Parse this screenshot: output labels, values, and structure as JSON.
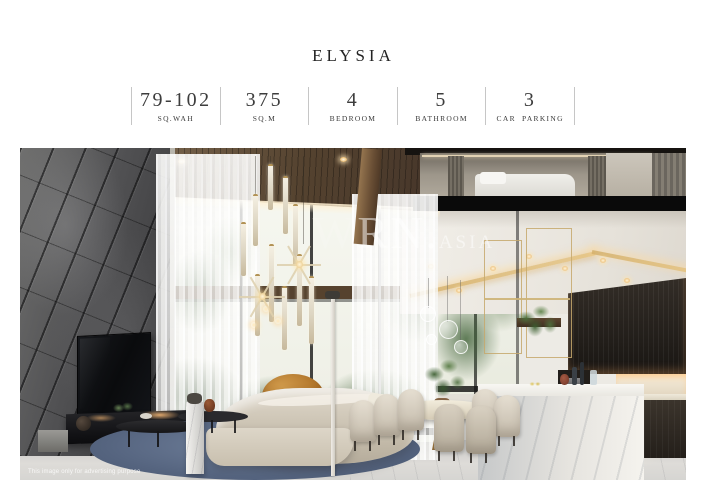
{
  "header": {
    "title": "ELYSIA"
  },
  "specs": [
    {
      "value": "79-102",
      "label": "SQ.WAH"
    },
    {
      "value": "375",
      "label": "SQ.M"
    },
    {
      "value": "4",
      "label": "BEDROOM"
    },
    {
      "value": "5",
      "label": "BATHROOM"
    },
    {
      "value": "3",
      "label": "CAR PARKING"
    }
  ],
  "photo": {
    "watermark": {
      "ghost": "W",
      "large": "RN.",
      "small": "ASIA"
    },
    "caption": "This image only for advertising purpose",
    "colors": {
      "stone_wall": "#4a4a4c",
      "wood_ceiling": "#54422f",
      "rug": "#55647f",
      "sofa": "#cfc6b5",
      "accent_chair": "#aa6c22",
      "cove_light": "#e6c482"
    }
  }
}
